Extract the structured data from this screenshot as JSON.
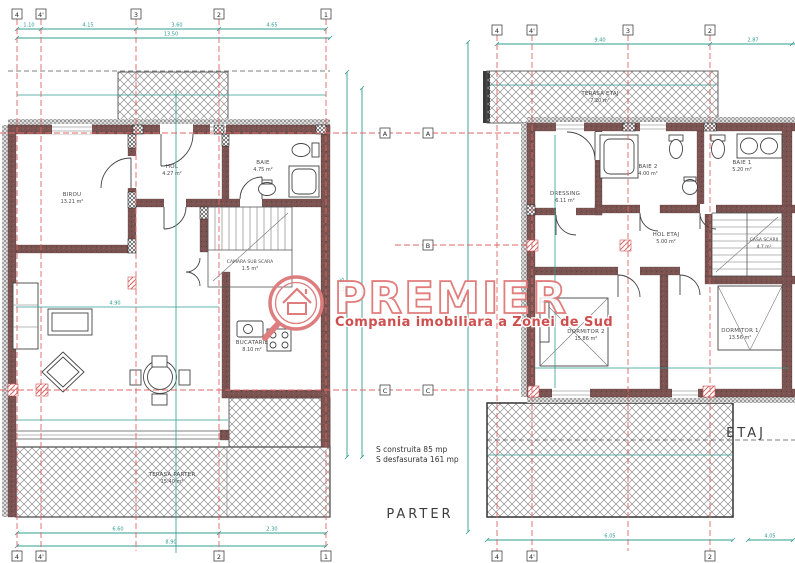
{
  "watermark": {
    "brand": "PREMIER",
    "tagline": "Compania imobiliara a Zonei de Sud"
  },
  "titles": {
    "parter": "PARTER",
    "etaj": "ETAJ"
  },
  "summary": {
    "line1": "S construita 85 mp",
    "line2": "S desfasurata 161 mp"
  },
  "grid": {
    "parter_top": [
      "4",
      "4'",
      "3",
      "2",
      "1"
    ],
    "parter_bottom": [
      "4",
      "4'",
      "2",
      "1"
    ],
    "etaj_top": [
      "4",
      "4'",
      "3",
      "2"
    ],
    "etaj_bottom": [
      "4",
      "4'",
      "2"
    ],
    "rows": {
      "a": "A",
      "b": "B",
      "c": "C"
    }
  },
  "rooms": {
    "parter": {
      "birou": {
        "name": "BIROU",
        "area": "13.21 m²"
      },
      "hol": {
        "name": "HOL",
        "area": "4.27 m²"
      },
      "baie": {
        "name": "BAIE",
        "area": "4.75 m²"
      },
      "camara": {
        "name": "CAMARA SUB SCARA",
        "area": "1.5 m²"
      },
      "bucatarie": {
        "name": "BUCATARIE",
        "area": "8.10 m²"
      },
      "terasa": {
        "name": "TERASA PARTER",
        "area": "15.40 m²"
      }
    },
    "etaj": {
      "terasa": {
        "name": "TERASA ETAJ",
        "area": "7.20 m²"
      },
      "dressing": {
        "name": "DRESSING",
        "area": "6.11 m²"
      },
      "baie2": {
        "name": "BAIE 2",
        "area": "4.00 m²"
      },
      "baie1": {
        "name": "BAIE 1",
        "area": "5.20 m²"
      },
      "hol": {
        "name": "HOL ETAJ",
        "area": "5.00 m²"
      },
      "casa_scarii": {
        "name": "CASA SCARII",
        "area": "4.7 m²"
      },
      "dormitor2": {
        "name": "DORMITOR 2",
        "area": "15.86 m²"
      },
      "dormitor1": {
        "name": "DORMITOR 1",
        "area": "13.56 m²"
      }
    }
  },
  "dims": {
    "parter_top": [
      "1.10",
      "4.15",
      "3.60",
      "4.65"
    ],
    "parter_top_total": "13.50",
    "parter_bottom_a": [
      "6.60",
      "2.30"
    ],
    "parter_bottom_b": "8.90",
    "parter_side": "12.05",
    "etaj_top": [
      "9.40",
      "2.87"
    ],
    "etaj_bottom": [
      "6.05",
      "4.05"
    ],
    "etaj_side": "11.10",
    "living_w": "4.90"
  },
  "colors": {
    "wall": "#7b5351",
    "dimension_teal": "#2f9c92",
    "grid_red": "#e06666",
    "watermark_red": "#e27d7d",
    "tagline_red": "#cf4f4f",
    "hatch_gray": "#8f8f8f"
  }
}
